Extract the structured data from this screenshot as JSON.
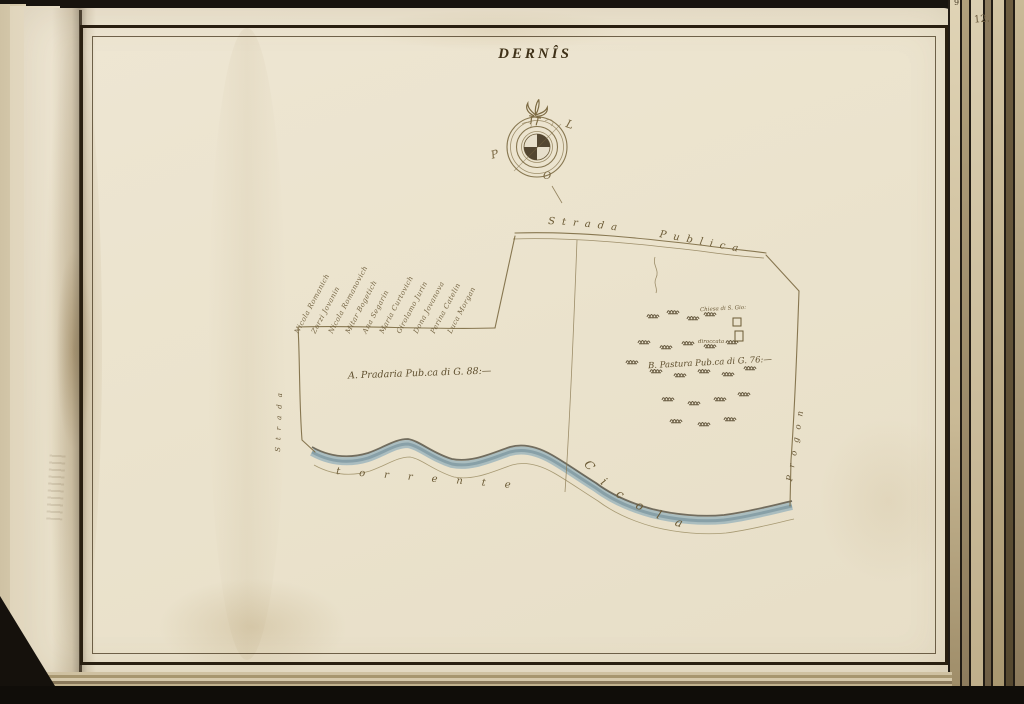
{
  "page": {
    "title": "DERNÎS",
    "page_number": "12.",
    "corner_number": "9"
  },
  "compass": {
    "north_symbol": "fleur-de-lis",
    "east_label": "L",
    "west_label": "P",
    "south_label": "O"
  },
  "map": {
    "road_label": "Strada Publica",
    "river_label_word1": "torrente",
    "river_label_word2": "Cicola",
    "left_road_label": "Strada",
    "right_lane_label": "Progon",
    "parcel_a_label": "A. Pradaria Pub.ca di G. 88:—",
    "parcel_b_label": "B. Pastura Pub.ca di G. 76:—",
    "chapel_label": "Chiesa di S. Gio:",
    "chapel_sublabel": "diroccata",
    "owners": [
      "Nicola Romanich",
      "Zorzi Jovanin",
      "Nicola Romanovich",
      "Mitar Bogetich",
      "Ana Segarin",
      "Maria Curtovich",
      "Girolamo Jurin",
      "Dona Jovanova",
      "Perina Catelin",
      "Luca Morgan"
    ]
  },
  "colors": {
    "paper": "#ece4d0",
    "ink": "#6b5a35",
    "frame": "#2a2112",
    "river": "#9fb6bd"
  }
}
